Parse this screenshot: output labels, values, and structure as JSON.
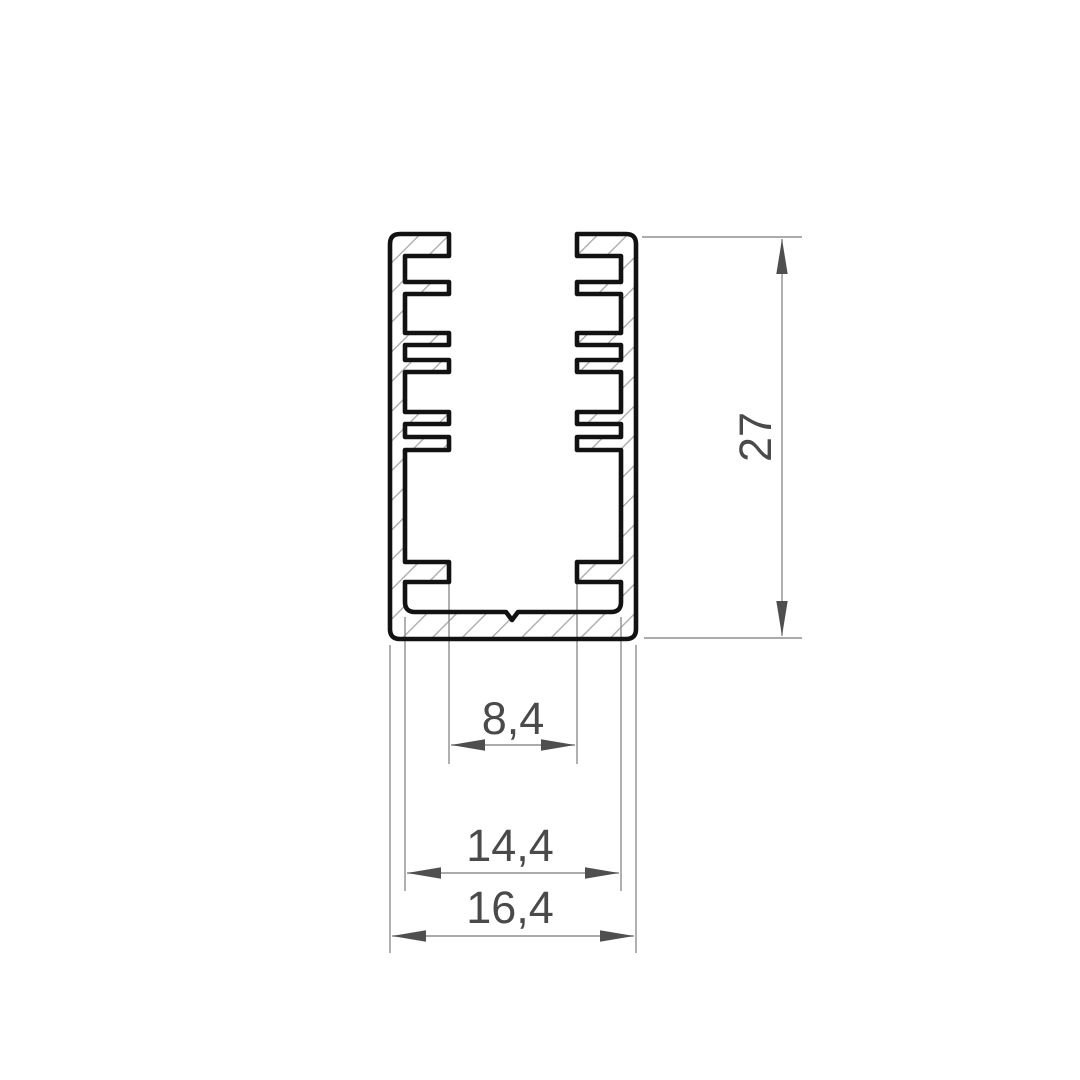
{
  "drawing": {
    "kind": "cross-section-profile"
  },
  "dimensions": {
    "height": {
      "label": "27"
    },
    "fin_tip_gap": {
      "label": "8,4"
    },
    "inner_width": {
      "label": "14,4"
    },
    "outer_width": {
      "label": "16,4"
    }
  },
  "colors": {
    "background": "#ffffff",
    "outline": "#121212",
    "hatch": "#ababab",
    "dimension_line": "#8f8f8f",
    "arrow": "#4f4f4f",
    "dimension_text": "#4a4a4a"
  }
}
